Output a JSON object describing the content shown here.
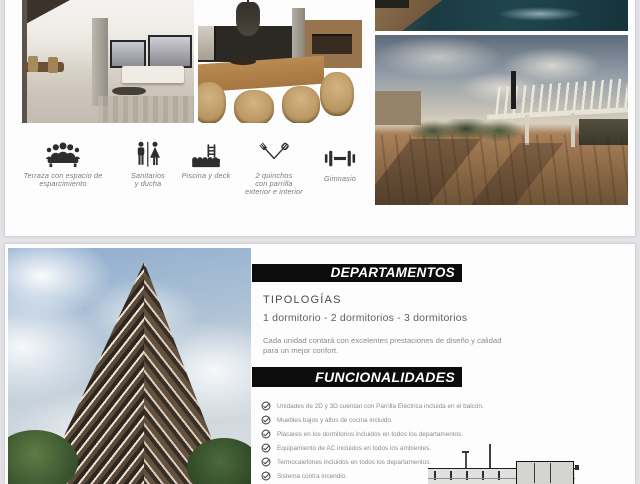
{
  "colors": {
    "page_background": "#e3e3e7",
    "card_background": "#fdfdfd",
    "banner_background": "#0c0c0c",
    "banner_text": "#ffffff",
    "heading_text": "#4b4b4b",
    "body_text": "#8b8b8b",
    "icon_color": "#2d2d2d"
  },
  "top_section": {
    "amenities": [
      {
        "icon": "meeting-icon",
        "lines": [
          "Terraza con espacio de",
          "esparcimiento"
        ]
      },
      {
        "icon": "restroom-icon",
        "lines": [
          "Sanitarios",
          "y ducha"
        ]
      },
      {
        "icon": "pool-ladder-icon",
        "lines": [
          "Piscina y deck"
        ]
      },
      {
        "icon": "grill-utensils-icon",
        "lines": [
          "2 quinchos",
          "con parrilla",
          "exterior e interior"
        ]
      },
      {
        "icon": "dumbbell-icon",
        "lines": [
          "Gimnasio"
        ]
      }
    ]
  },
  "bottom_section": {
    "departamentos": {
      "title": "DEPARTAMENTOS"
    },
    "tipologias": {
      "heading": "TIPOLOGÍAS",
      "options": "1 dormitorio - 2 dormitorios - 3 dormitorios",
      "description_lines": [
        "Cada unidad contará con excelentes prestaciones de diseño y calidad",
        "para un mejor confort."
      ]
    },
    "funcionalidades": {
      "title": "FUNCIONALIDADES",
      "check_icon": "check-circle-icon",
      "features": [
        "Unidades de 2D y 3D cuentan con Parrilla Eléctrica incluida en el balcón.",
        "Muebles bajos y altos de cocina incluido.",
        "Placares en los dormitorios incluidos en todos los departamentos.",
        "Equipamiento de AC incluidos en todos los ambientes.",
        "Termocalefones incluidos en todos los departamentos.",
        "Sistema contra incendio."
      ]
    }
  }
}
